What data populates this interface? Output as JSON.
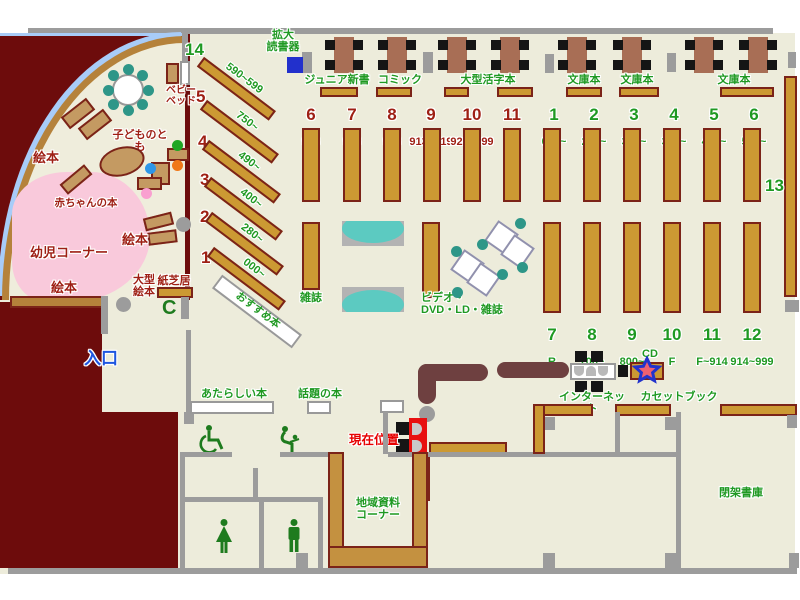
{
  "labels": {
    "magnifier": "拡大\n読書器",
    "junior_shinsho": "ジュニア新書",
    "comics": "コミック",
    "large_print": "大型活字本",
    "bunko_a": "文庫本",
    "bunko_b": "文庫本",
    "bunko_c": "文庫本",
    "baby_bed": "ベビー\nベッド",
    "kodomo_no_tomo": "子どものとも",
    "ehon_a": "絵本",
    "ehon_b": "絵本",
    "ehon_c": "絵本",
    "baby_books": "赤ちゃんの本",
    "kids_corner": "幼児コーナー",
    "large_ehon": "大型\n絵本",
    "kamishibai": "紙芝居",
    "recommended": "おすすめ本",
    "entrance": "入口",
    "magazines": "雑誌",
    "av_corner": "ビデオ・\nDVD・LD・雑誌",
    "new_books": "あたらしい本",
    "topic_books": "話題の本",
    "current_location": "現在位置",
    "internet": "インターネット",
    "cd": "CD",
    "cassette_books": "カセットブック",
    "local_materials": "地域資料\nコーナー",
    "closed_stacks": "閉架書庫",
    "shelf_13": "13"
  },
  "diagonal_shelves": [
    {
      "num": "14",
      "range": "590~599"
    },
    {
      "num": "5",
      "range": "750~"
    },
    {
      "num": "4",
      "range": "490~"
    },
    {
      "num": "3",
      "range": "400~"
    },
    {
      "num": "2",
      "range": "280~"
    },
    {
      "num": "1",
      "range": "000~"
    }
  ],
  "children_shelves": [
    {
      "num": "6",
      "range": "913"
    },
    {
      "num": "7",
      "range": "913"
    },
    {
      "num": "8",
      "range": "913"
    },
    {
      "num": "9",
      "range": "913~919"
    },
    {
      "num": "10",
      "range": "920~999"
    },
    {
      "num": "11",
      "range": ""
    }
  ],
  "adult_shelves_top": [
    {
      "num": "1",
      "range": "000~"
    },
    {
      "num": "2",
      "range": "220~"
    },
    {
      "num": "3",
      "range": "300~"
    },
    {
      "num": "4",
      "range": "360~"
    },
    {
      "num": "5",
      "range": "400~"
    },
    {
      "num": "6",
      "range": "500~"
    }
  ],
  "adult_shelves_bottom": [
    {
      "num": "7",
      "range": "R"
    },
    {
      "num": "8",
      "range": "700~"
    },
    {
      "num": "9",
      "range": "800~"
    },
    {
      "num": "10",
      "range": "F"
    },
    {
      "num": "11",
      "range": "F~914"
    },
    {
      "num": "12",
      "range": "914~999"
    }
  ],
  "colors": {
    "green_label": "#1f9922",
    "children_label": "#9e1f14",
    "alert_red": "#e60000",
    "entrance_blue": "#1e56e0",
    "shelf_wood": "#cc9933",
    "outside_dark": "#6d0c0c",
    "kids_pink": "#f9c9db",
    "glass_blue": "#a8ccf8",
    "device_blue": "#2230cc"
  }
}
